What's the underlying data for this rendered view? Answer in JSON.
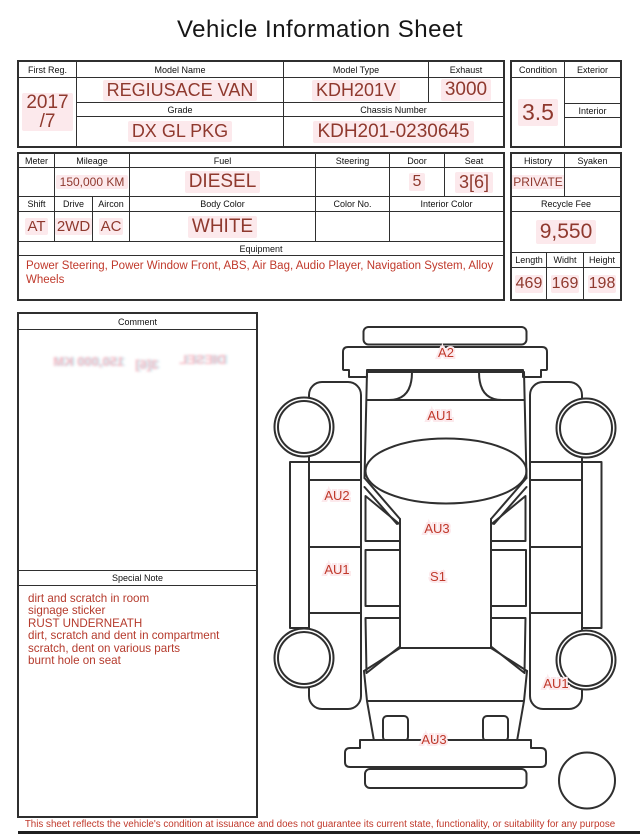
{
  "title": "Vehicle Information Sheet",
  "reg_table": {
    "first_reg_label": "First Reg.",
    "first_reg_line1": "2017",
    "first_reg_line2": "/7",
    "model_name_label": "Model Name",
    "model_name": "REGIUSACE VAN",
    "model_type_label": "Model Type",
    "model_type": "KDH201V",
    "exhaust_label": "Exhaust",
    "exhaust": "3000",
    "grade_label": "Grade",
    "grade": "DX GL PKG",
    "chassis_number_label": "Chassis Number",
    "chassis_number": "KDH201-0230645"
  },
  "condition_table": {
    "condition_label": "Condition",
    "condition": "3.5",
    "exterior_label": "Exterior",
    "interior_label": "Interior"
  },
  "spec_table": {
    "meter_label": "Meter",
    "mileage_label": "Mileage",
    "mileage": "150,000 KM",
    "fuel_label": "Fuel",
    "fuel": "DIESEL",
    "steering_label": "Steering",
    "door_label": "Door",
    "door": "5",
    "seat_label": "Seat",
    "seat": "3[6]",
    "shift_label": "Shift",
    "shift": "AT",
    "drive_label": "Drive",
    "drive": "2WD",
    "aircon_label": "Aircon",
    "aircon": "AC",
    "body_color_label": "Body Color",
    "body_color": "WHITE",
    "color_no_label": "Color No.",
    "interior_color_label": "Interior Color",
    "equipment_label": "Equipment",
    "equipment": "Power Steering, Power Window  Front, ABS, Air Bag, Audio Player, Navigation System, Alloy Wheels"
  },
  "history_table": {
    "history_label": "History",
    "history": "PRIVATE",
    "syaken_label": "Syaken",
    "recycle_fee_label": "Recycle Fee",
    "recycle_fee": "9,550",
    "length_label": "Length",
    "length": "469",
    "width_label": "Widht",
    "width": "169",
    "height_label": "Height",
    "height": "198"
  },
  "comment": {
    "label": "Comment",
    "ghosts": [
      "150,000 KM",
      "3[6]",
      "DIESEL"
    ]
  },
  "special_note": {
    "label": "Special Note",
    "lines": [
      "dirt and scratch in room",
      "signage sticker",
      "RUST UNDERNEATH",
      "dirt, scratch and dent in compartment",
      "scratch, dent on various parts",
      "burnt hole on seat"
    ]
  },
  "diagram": {
    "labels": [
      {
        "text": "A2",
        "x": 446,
        "y": 357
      },
      {
        "text": "AU1",
        "x": 440,
        "y": 420
      },
      {
        "text": "AU2",
        "x": 337,
        "y": 500
      },
      {
        "text": "AU3",
        "x": 437,
        "y": 533
      },
      {
        "text": "AU1",
        "x": 337,
        "y": 574
      },
      {
        "text": "S1",
        "x": 438,
        "y": 581
      },
      {
        "text": "AU1",
        "x": 556,
        "y": 688
      },
      {
        "text": "AU3",
        "x": 434,
        "y": 744
      }
    ]
  },
  "footer": "This sheet reflects the vehicle's condition at issuance and does not guarantee its current state, functionality, or suitability for any purpose"
}
